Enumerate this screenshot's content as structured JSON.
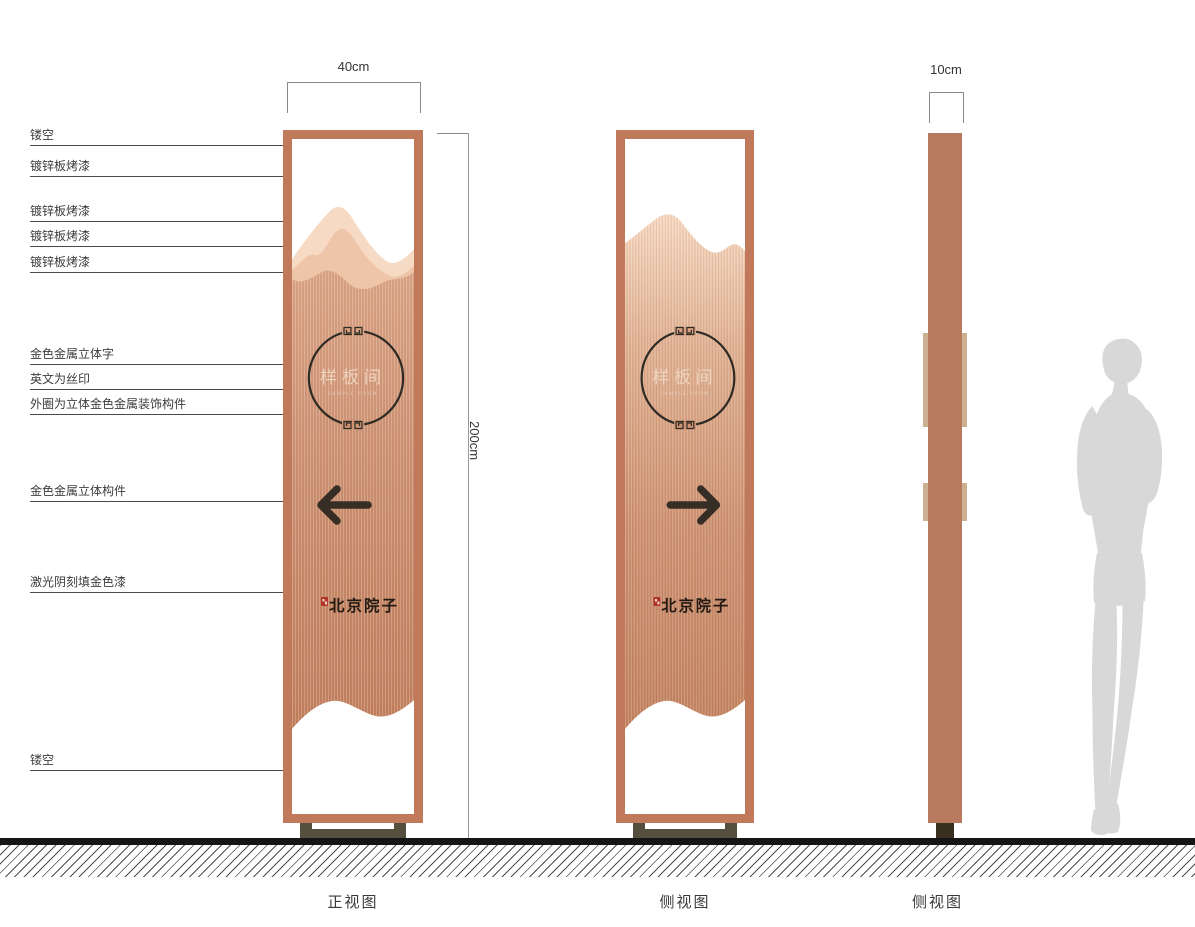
{
  "callouts": [
    "镂空",
    "镀锌板烤漆",
    "镀锌板烤漆",
    "镀锌板烤漆",
    "镀锌板烤漆",
    "金色金属立体字",
    "英文为丝印",
    "外圈为立体金色金属装饰构件",
    "金色金属立体构件",
    "激光阴刻填金色漆",
    "镂空"
  ],
  "dimensions": {
    "width": "40cm",
    "height": "200cm",
    "depth": "10cm"
  },
  "sign": {
    "name": "样板间",
    "subtitle_en": "SAMPLE ROOM",
    "brand": "北京院子"
  },
  "views": [
    "正视图",
    "侧视图",
    "侧视图"
  ],
  "colors": {
    "frame": "#c07a5b",
    "body_copper": "#cc9070",
    "mountain_light": "#f6dac4",
    "mountain_mid": "#eec5a9",
    "accent_dark": "#362e25",
    "seal_red": "#b23428",
    "base": "#54503d",
    "ground": "#161616",
    "silhouette": "#d8d8d8"
  }
}
